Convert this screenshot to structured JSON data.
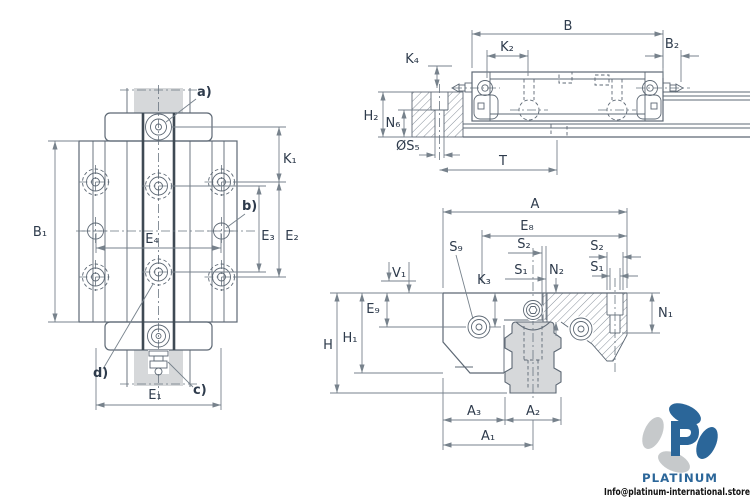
{
  "palette": {
    "line": "#5d6874",
    "dim_line": "#77828c",
    "label_text": "#2e3b4c",
    "dark_band": "#3f4a54",
    "rail_fill": "#d6d8da",
    "hatch": "#7a8590",
    "logo_blue": "#2b6699",
    "logo_gray": "#c6c9cb",
    "email_color": "#111111"
  },
  "labels": {
    "top": {
      "b1": "B₁",
      "k1": "K₁",
      "e1": "E₁",
      "e2": "E₂",
      "e3": "E₃",
      "e4": "E₄",
      "a": "a)",
      "b": "b)",
      "c": "c)",
      "d": "d)"
    },
    "side": {
      "b": "B",
      "k2": "K₂",
      "b2": "B₂",
      "k4": "K₄",
      "h2": "H₂",
      "n6": "N₆",
      "s5": "ØS₅",
      "t": "T"
    },
    "section": {
      "a": "A",
      "e8": "E₈",
      "s9": "S₉",
      "k3": "K₃",
      "s2c": "S₂",
      "s1c": "S₁",
      "n2": "N₂",
      "s2r": "S₂",
      "s1r": "S₁",
      "n1": "N₁",
      "v1": "V₁",
      "e9": "E₉",
      "h": "H",
      "h1": "H₁",
      "a1": "A₁",
      "a2": "A₂",
      "a3": "A₃"
    }
  },
  "branding": {
    "wordmark": "PLATINUM",
    "email": "Info@platinum-international.store"
  }
}
